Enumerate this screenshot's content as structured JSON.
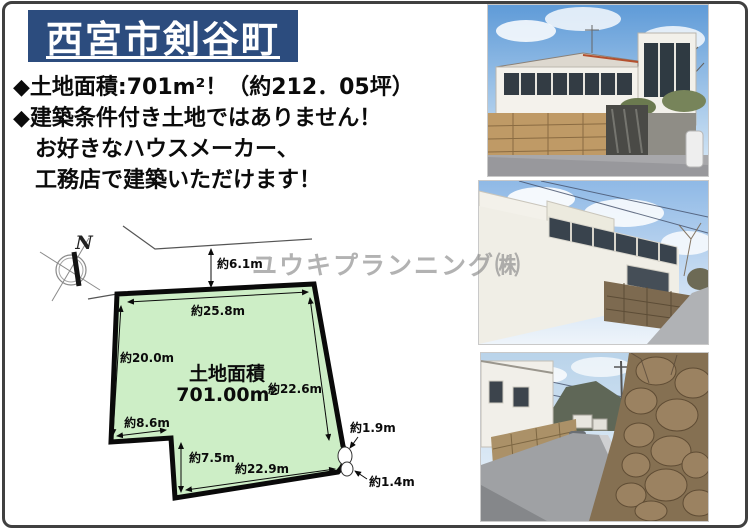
{
  "header": {
    "title": "西宮市剣谷町",
    "title_bg": "#2c4c7e",
    "title_color": "#ffffff"
  },
  "bullets": {
    "line1": "◆土地面積:701m²！（約212．05坪）",
    "line2": "◆建築条件付き土地ではありません！",
    "line3": "お好きなハウスメーカー、",
    "line4": "工務店で建築いただけます！"
  },
  "watermark": {
    "text": "ユウキプランニング㈱",
    "color": "#8e8e8e"
  },
  "diagram": {
    "north_label": "N",
    "plot_fill": "#cdeec6",
    "plot_border": "#0a0a0a",
    "area_title": "土地面積",
    "area_value": "701.00m²",
    "dims": {
      "road_offset": "約6.1m",
      "top": "約25.8m",
      "left": "約20.0m",
      "right": "約22.6m",
      "bottom": "約22.9m",
      "step": "約8.6m",
      "notch": "約7.5m",
      "corner_a": "約1.9m",
      "corner_b": "約1.4m"
    }
  },
  "photos": [
    {
      "alt": "White two-story house behind a stone retaining wall under blue sky"
    },
    {
      "alt": "Large white building wall with upper windows beside a sloping road"
    },
    {
      "alt": "Narrow street with a tall boulder stone wall on the right and house on the left"
    }
  ]
}
